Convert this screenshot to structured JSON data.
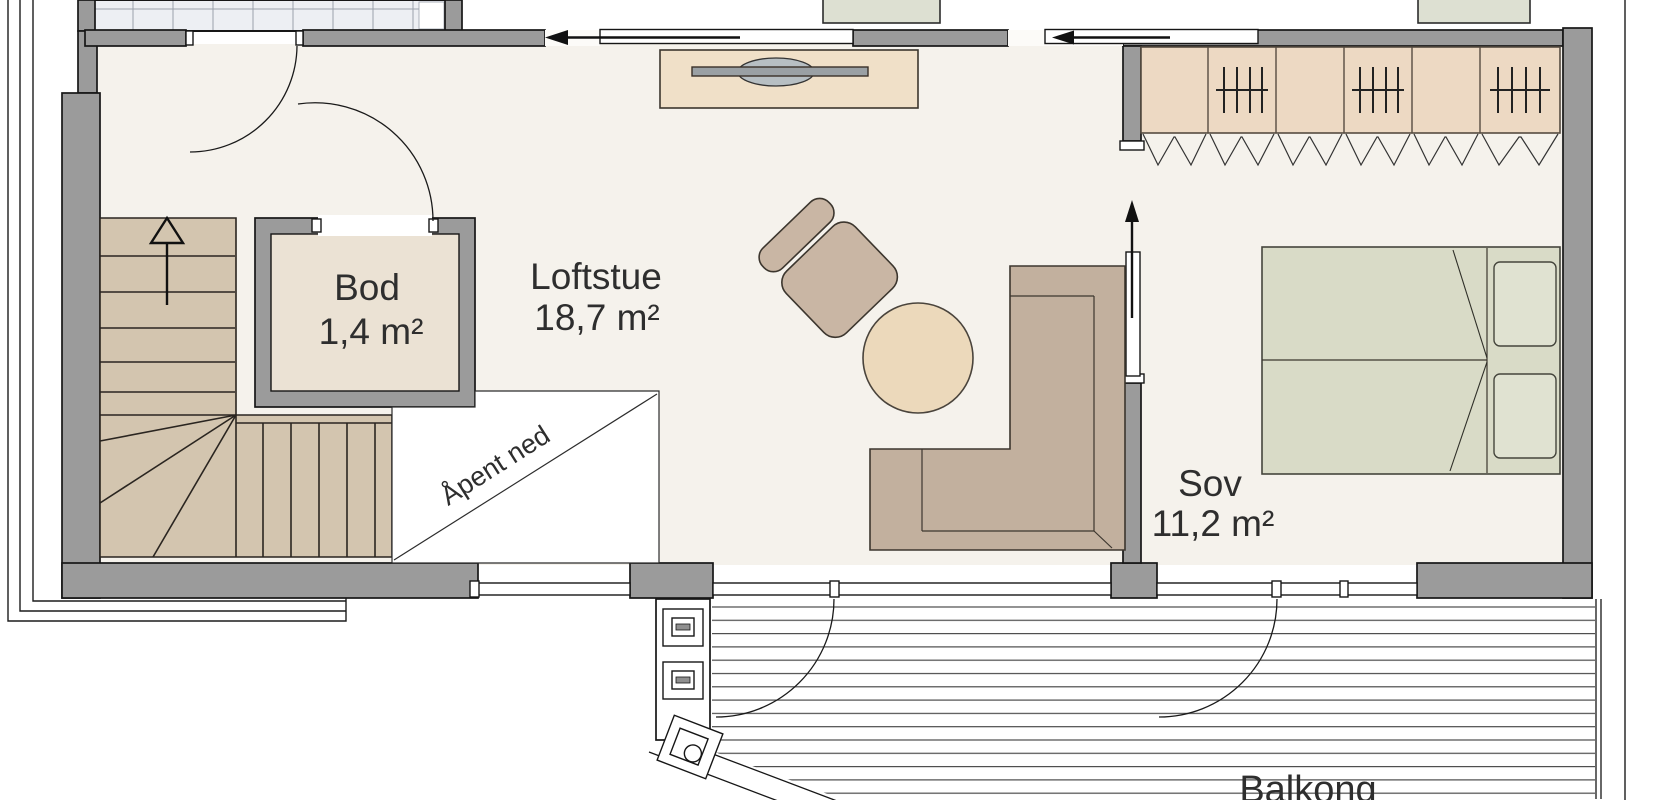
{
  "rooms": [
    {
      "name": "Bod",
      "area": "1,4 m²"
    },
    {
      "name": "Loftstue",
      "area": "18,7 m²"
    },
    {
      "name": "Sov",
      "area": "11,2 m²"
    }
  ],
  "annotations": {
    "open_below": "Åpent ned",
    "balcony": "Balkong"
  },
  "colors": {
    "wall": "#9b9b9b",
    "floor": "#f5f2ec",
    "stairs": "#d3c5af",
    "bod_floor": "#ebe2d4",
    "wardrobe": "#edd9c3",
    "bench": "#f0e0c8",
    "tv": "#b7bfc3",
    "armchair": "#c9b6a4",
    "sofa": "#c2b09e",
    "table": "#ecd9bb",
    "bed": "#d9dbc7",
    "pillow": "#e0e2d1",
    "window_glass": "#edeff3",
    "cabinet_green": "#dde0d2",
    "text": "#2e2e2e"
  }
}
